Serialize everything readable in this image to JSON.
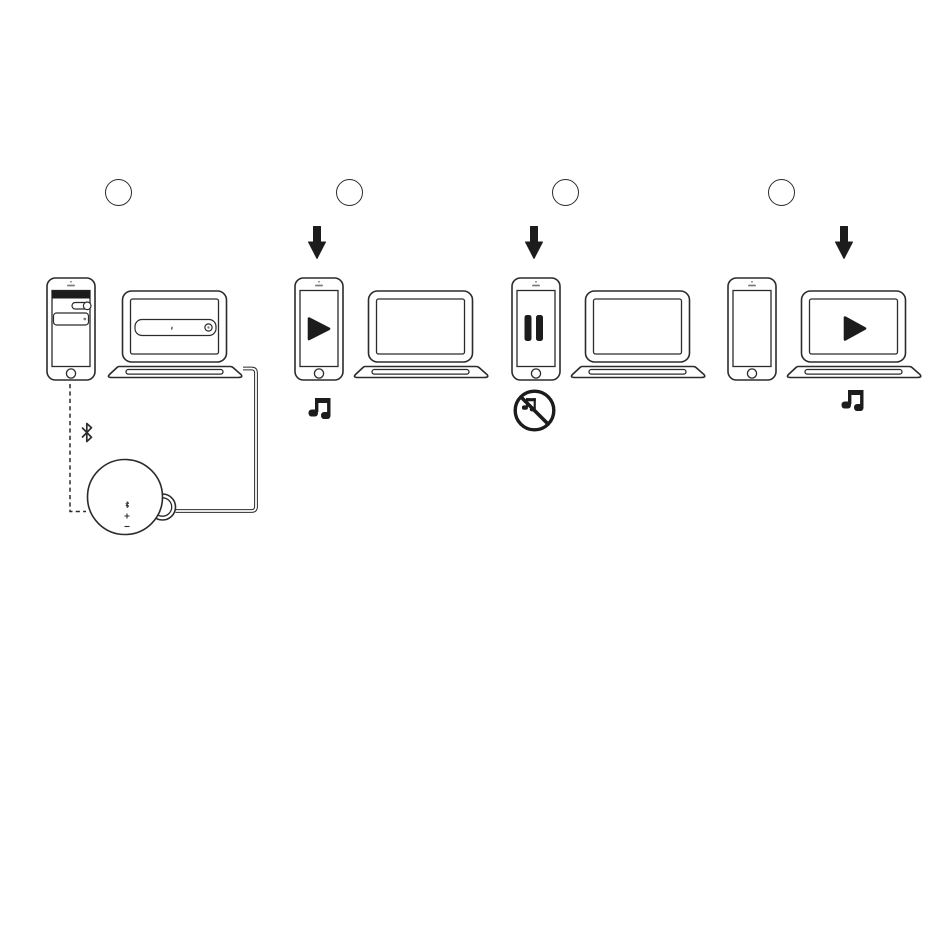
{
  "canvas": {
    "width": 950,
    "height": 951,
    "background": "#ffffff"
  },
  "colors": {
    "line": "#2b2b2b",
    "ink": "#1c1c1c"
  },
  "steps": [
    {
      "marker_label": "",
      "phone_screen": "bluetooth-settings",
      "phone_elements": [
        "status-bar",
        "toggle-switch-on",
        "device-list-field"
      ],
      "laptop_screen": "bluetooth-search-field",
      "connections": [
        "dashed-pairing-line",
        "bluetooth-icon",
        "audio-cable"
      ],
      "speaker_controls": [
        "pairing-mark",
        "volume-plus",
        "volume-minus"
      ]
    },
    {
      "marker_label": "",
      "arrow_over": "phone",
      "phone_screen": "play-icon",
      "laptop_screen": "blank",
      "result_icon": "music-note-icon"
    },
    {
      "marker_label": "",
      "arrow_over": "phone",
      "phone_screen": "pause-icon",
      "laptop_screen": "blank",
      "result_icon": "no-music-icon"
    },
    {
      "marker_label": "",
      "arrow_over": "laptop",
      "phone_screen": "blank",
      "laptop_screen": "play-icon",
      "result_icon": "music-note-icon"
    }
  ]
}
